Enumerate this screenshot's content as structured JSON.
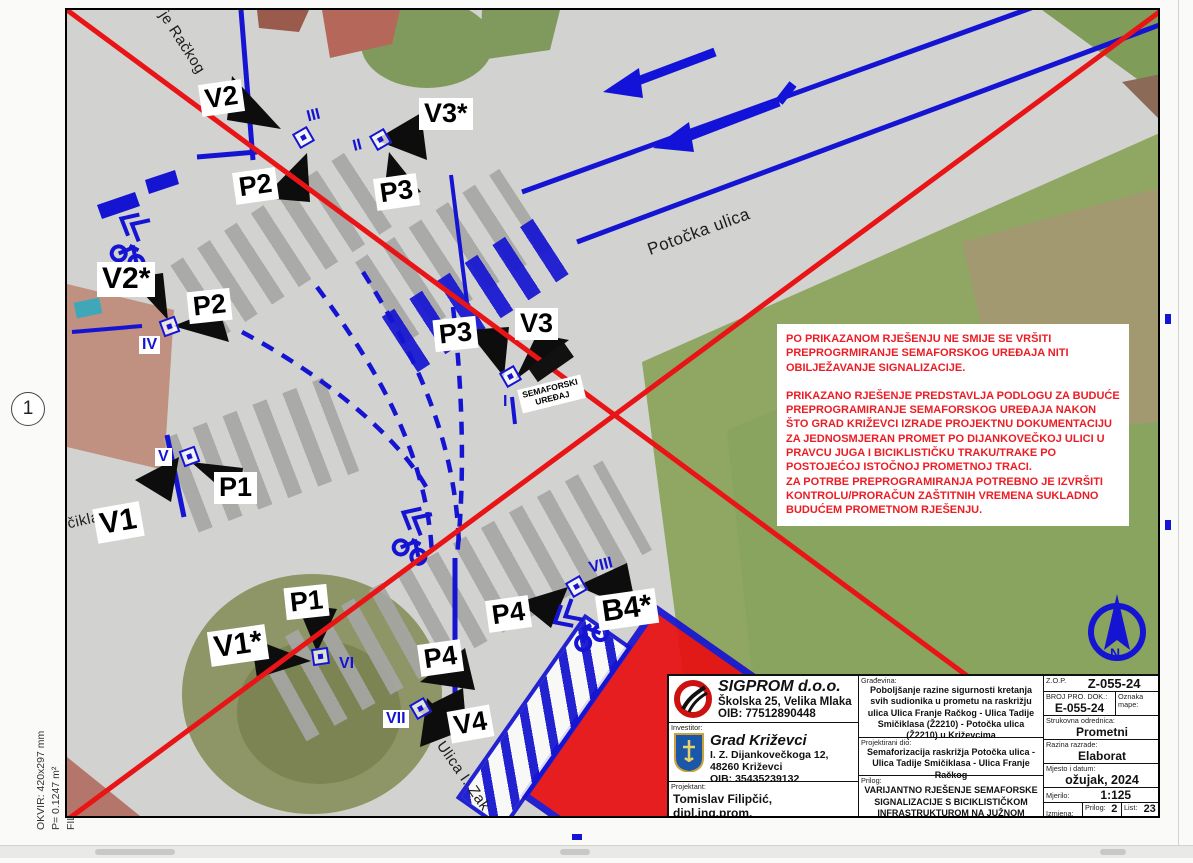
{
  "page": {
    "sheet_number": "1",
    "margin": {
      "okvir": "OKVIR: 420x297 mm",
      "area": "P= 0.1247 m²",
      "file": "FILE: SEMAFOR-KRIZEVCI - BICIKLISTI.DWG, 2.4.2024, 22:43:43"
    }
  },
  "streets": [
    "je Račkog",
    "Potočka ulica",
    "čiklasa",
    "Ulica I. Zak"
  ],
  "signals": [
    {
      "label": "V2"
    },
    {
      "label": "P2"
    },
    {
      "label": "V3*"
    },
    {
      "label": "P3"
    },
    {
      "label": "V2*"
    },
    {
      "label": "P2"
    },
    {
      "label": "P3"
    },
    {
      "label": "V3"
    },
    {
      "label": "V1"
    },
    {
      "label": "P1"
    },
    {
      "label": "P1"
    },
    {
      "label": "V1*"
    },
    {
      "label": "P4"
    },
    {
      "label": "B4*"
    },
    {
      "label": "P4"
    },
    {
      "label": "V4"
    }
  ],
  "romans": [
    "III",
    "II",
    "IV",
    "V",
    "I",
    "VI",
    "VII",
    "VIII"
  ],
  "device": {
    "line1": "SEMAFORSKI",
    "line2": "UREĐAJ"
  },
  "warning": {
    "p1": "PO PRIKAZANOM RJEŠENJU NE SMIJE SE VRŠITI PREPROGRMIRANJE SEMAFORSKOG UREĐAJA NITI OBILJEŽAVANJE SIGNALIZACIJE.",
    "p2": "PRIKAZANO RJEŠENJE PREDSTAVLJA PODLOGU ZA BUDUĆE PREPROGRAMIRANJE SEMAFORSKOG UREĐAJA NAKON ŠTO GRAD KRIŽEVCI IZRADE PROJEKTNU DOKUMENTACIJU ZA JEDNOSMJERAN PROMET PO DIJANKOVEČKOJ ULICI U PRAVCU JUGA I BICIKLISTIČKU TRAKU/TRAKE PO POSTOJEĆOJ ISTOČNOJ PROMETNOJ TRACI.",
    "p3": "ZA POTRBE PREPROGRAMIRANJA POTREBNO JE IZVRŠITI KONTROLU/PRORAČUN ZAŠTITNIH VREMENA SUKLADNO BUDUĆEM PROMETNOM RJEŠENJU."
  },
  "tb": {
    "company": {
      "name": "SIGPROM d.o.o.",
      "address": "Školska 25, Velika Mlaka",
      "oib": "OIB: 77512890448"
    },
    "investor_label": "Investitor:",
    "investor": {
      "name": "Grad Križevci",
      "address1": "I. Z. Dijankovečkoga 12,",
      "address2": "48260 Križevci",
      "oib": "OIB: 35435239132"
    },
    "designer_label": "Projektant:",
    "designer": "Tomislav Filipčić, dipl.ing.prom.",
    "gradevina_label": "Građevina:",
    "gradevina": "Poboljšanje razine sigurnosti kretanja svih sudionika u prometu na raskrižju ulica Ulica Franje Račkog - Ulica Tadije Smičiklasa (Ž2210) - Potočka ulica (Ž2210) u Križevcima",
    "proj_dio_label": "Projektirani dio:",
    "proj_dio": "Semaforizacija raskrižja Potočka ulica - Ulica Tadije Smičiklasa - Ulica Franje Račkog",
    "prilog_label": "Prilog:",
    "prilog": "VARIJANTNO RJEŠENJE SEMAFORSKE SIGNALIZACIJE S BICIKLISTIČKOM INFRASTRUKTUROM NA JUŽNOM PRILAZU",
    "zop_label": "Z.O.P.",
    "zop": "Z-055-24",
    "broj_label": "BROJ PRO. DOK.:",
    "broj": "E-055-24",
    "oznaka_label": "Oznaka mape:",
    "struk_label": "Strukovna odrednica:",
    "struk": "Prometni",
    "razina_label": "Razina razrade:",
    "razina": "Elaborat",
    "mjesto_label": "Mjesto i datum:",
    "mjesto": "ožujak, 2024",
    "mjerilo_label": "Mjerilo:",
    "mjerilo": "1:125",
    "izmjena_label": "Izmjena:",
    "prilog_num_label": "Prilog:",
    "prilog_num": "2",
    "list_label": "List:",
    "list_num": "23"
  },
  "colors": {
    "accent_blue": "#1414d2",
    "overlay_red": "#e81416",
    "warning_red": "#ed1c24"
  }
}
